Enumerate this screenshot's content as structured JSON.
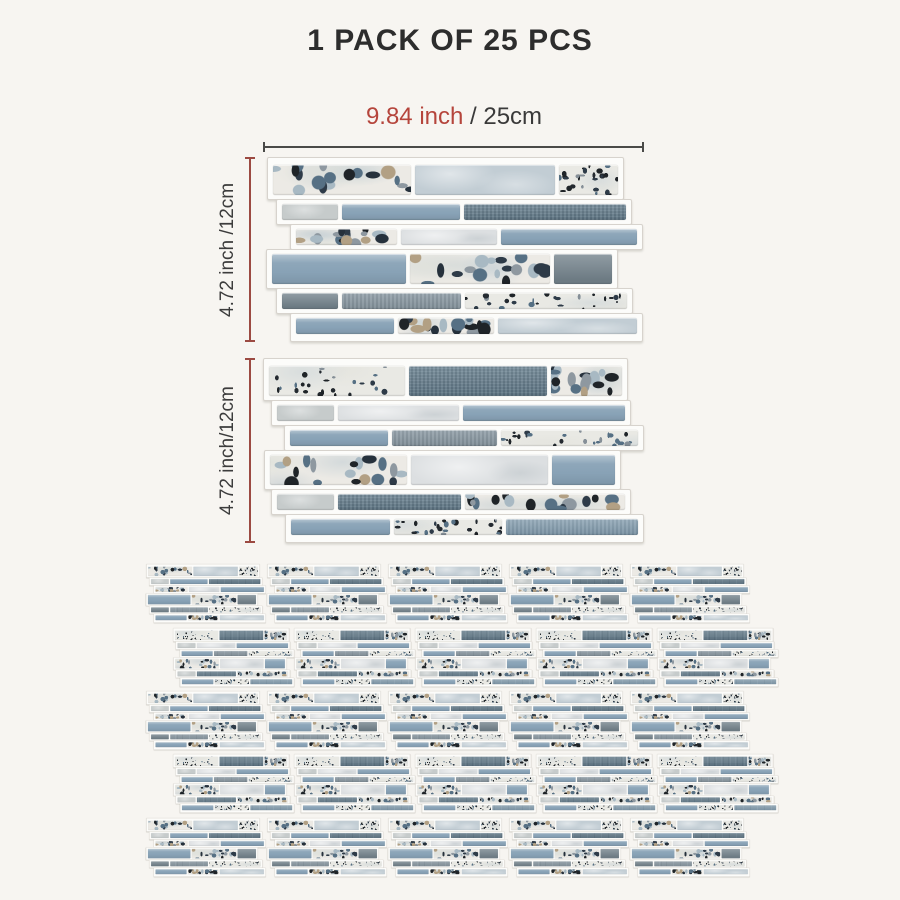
{
  "title": "1 PACK OF 25 PCS",
  "dimensions": {
    "width_inch": "9.84 inch",
    "width_rest": " / 25cm",
    "height_label_1": "4.72 inch /12cm",
    "height_label_2": "4.72 inch/12cm",
    "accent_red": "#b5453c",
    "line_dark": "#4a4a48",
    "line_red": "#9c4a42",
    "text_dark": "#3c3c3c"
  },
  "pack": {
    "pieces": 25,
    "grid_rows": [
      {
        "design": "A",
        "x": 145,
        "y": 564
      },
      {
        "design": "B",
        "x": 173,
        "y": 628
      },
      {
        "design": "A",
        "x": 145,
        "y": 691
      },
      {
        "design": "B",
        "x": 173,
        "y": 754
      },
      {
        "design": "A",
        "x": 145,
        "y": 818
      }
    ],
    "panels_per_row": 5,
    "small_scale": 0.318
  },
  "tile_palette": {
    "terrazzo_base": "#eceae5",
    "plain_light_blue": "#c2cdd4",
    "plain_white": "#dcdfe1",
    "gray_light": "#c6cbcb",
    "blue_glass": "#88a2b6",
    "blue_dark_fabric": "#637c8c",
    "gray_mid_fabric": "#8796a0",
    "gray_dark": "#75848d",
    "blue_fabric": "#7e98aa",
    "grout_white": "#fcfcfa",
    "background": "#f7f5f1"
  },
  "speckles": {
    "terrazzoBig": {
      "count": 18,
      "min": 2.5,
      "max": 8,
      "colors": [
        "#26313c",
        "#1f2428",
        "#8e98a0",
        "#b2a084",
        "#567084",
        "#a8b9c3",
        "#2e3b48"
      ],
      "patches": [
        "rgba(182,198,207,0.45)",
        "rgba(224,226,220,0.9)",
        "rgba(167,185,196,0.35)"
      ]
    },
    "terrazzoFine": {
      "count": 26,
      "min": 1,
      "max": 3.4,
      "colors": [
        "#242a30",
        "#2e3b48",
        "#858f97",
        "#567084",
        "#1f2428"
      ],
      "patches": [
        "rgba(200,210,215,0.5)",
        "rgba(228,228,222,0.8)"
      ]
    }
  },
  "panels": {
    "A": {
      "left": 263,
      "top": 157,
      "rows": [
        {
          "tall": true,
          "offset": 4,
          "tiles": [
            [
              "terrazzoBig",
              138
            ],
            [
              "plainLight",
              140
            ],
            [
              "terrazzoFine",
              59
            ]
          ]
        },
        {
          "tall": false,
          "offset": 13,
          "tiles": [
            [
              "grayLight",
              56
            ],
            [
              "blue",
              118
            ],
            [
              "blueDark",
              162
            ]
          ]
        },
        {
          "tall": false,
          "offset": 27,
          "tiles": [
            [
              "terrazzoBig",
              101
            ],
            [
              "plainWhite",
              96
            ],
            [
              "blue",
              136
            ]
          ]
        },
        {
          "tall": true,
          "offset": 3,
          "tiles": [
            [
              "blue",
              134
            ],
            [
              "terrazzoBig",
              140
            ],
            [
              "grayDark",
              58
            ]
          ]
        },
        {
          "tall": false,
          "offset": 13,
          "tiles": [
            [
              "grayDark",
              56
            ],
            [
              "grayMid",
              119
            ],
            [
              "terrazzoFine",
              162
            ]
          ]
        },
        {
          "tall": false,
          "offset": 27,
          "tiles": [
            [
              "blue",
              98
            ],
            [
              "terrazzoBig",
              96
            ],
            [
              "plainLight",
              139
            ]
          ]
        }
      ]
    },
    "B": {
      "left": 263,
      "top": 358,
      "rows": [
        {
          "tall": true,
          "offset": 0,
          "tiles": [
            [
              "terrazzoFine",
              136
            ],
            [
              "blueDark",
              138
            ],
            [
              "terrazzoBig",
              71
            ]
          ]
        },
        {
          "tall": false,
          "offset": 8,
          "tiles": [
            [
              "grayLight",
              57
            ],
            [
              "plainWhite",
              121
            ],
            [
              "blue",
              162
            ]
          ]
        },
        {
          "tall": false,
          "offset": 21,
          "tiles": [
            [
              "blue",
              98
            ],
            [
              "grayMid",
              105
            ],
            [
              "terrazzoFine",
              137
            ]
          ]
        },
        {
          "tall": true,
          "offset": 1,
          "tiles": [
            [
              "terrazzoBig",
              137
            ],
            [
              "plainWhite",
              137
            ],
            [
              "blue",
              63
            ]
          ]
        },
        {
          "tall": false,
          "offset": 8,
          "tiles": [
            [
              "grayLight",
              57
            ],
            [
              "blueDark",
              123
            ],
            [
              "terrazzoBig",
              160
            ]
          ]
        },
        {
          "tall": false,
          "offset": 22,
          "tiles": [
            [
              "blue",
              99
            ],
            [
              "terrazzoFine",
              108
            ],
            [
              "blueTex",
              132
            ]
          ]
        }
      ]
    }
  }
}
